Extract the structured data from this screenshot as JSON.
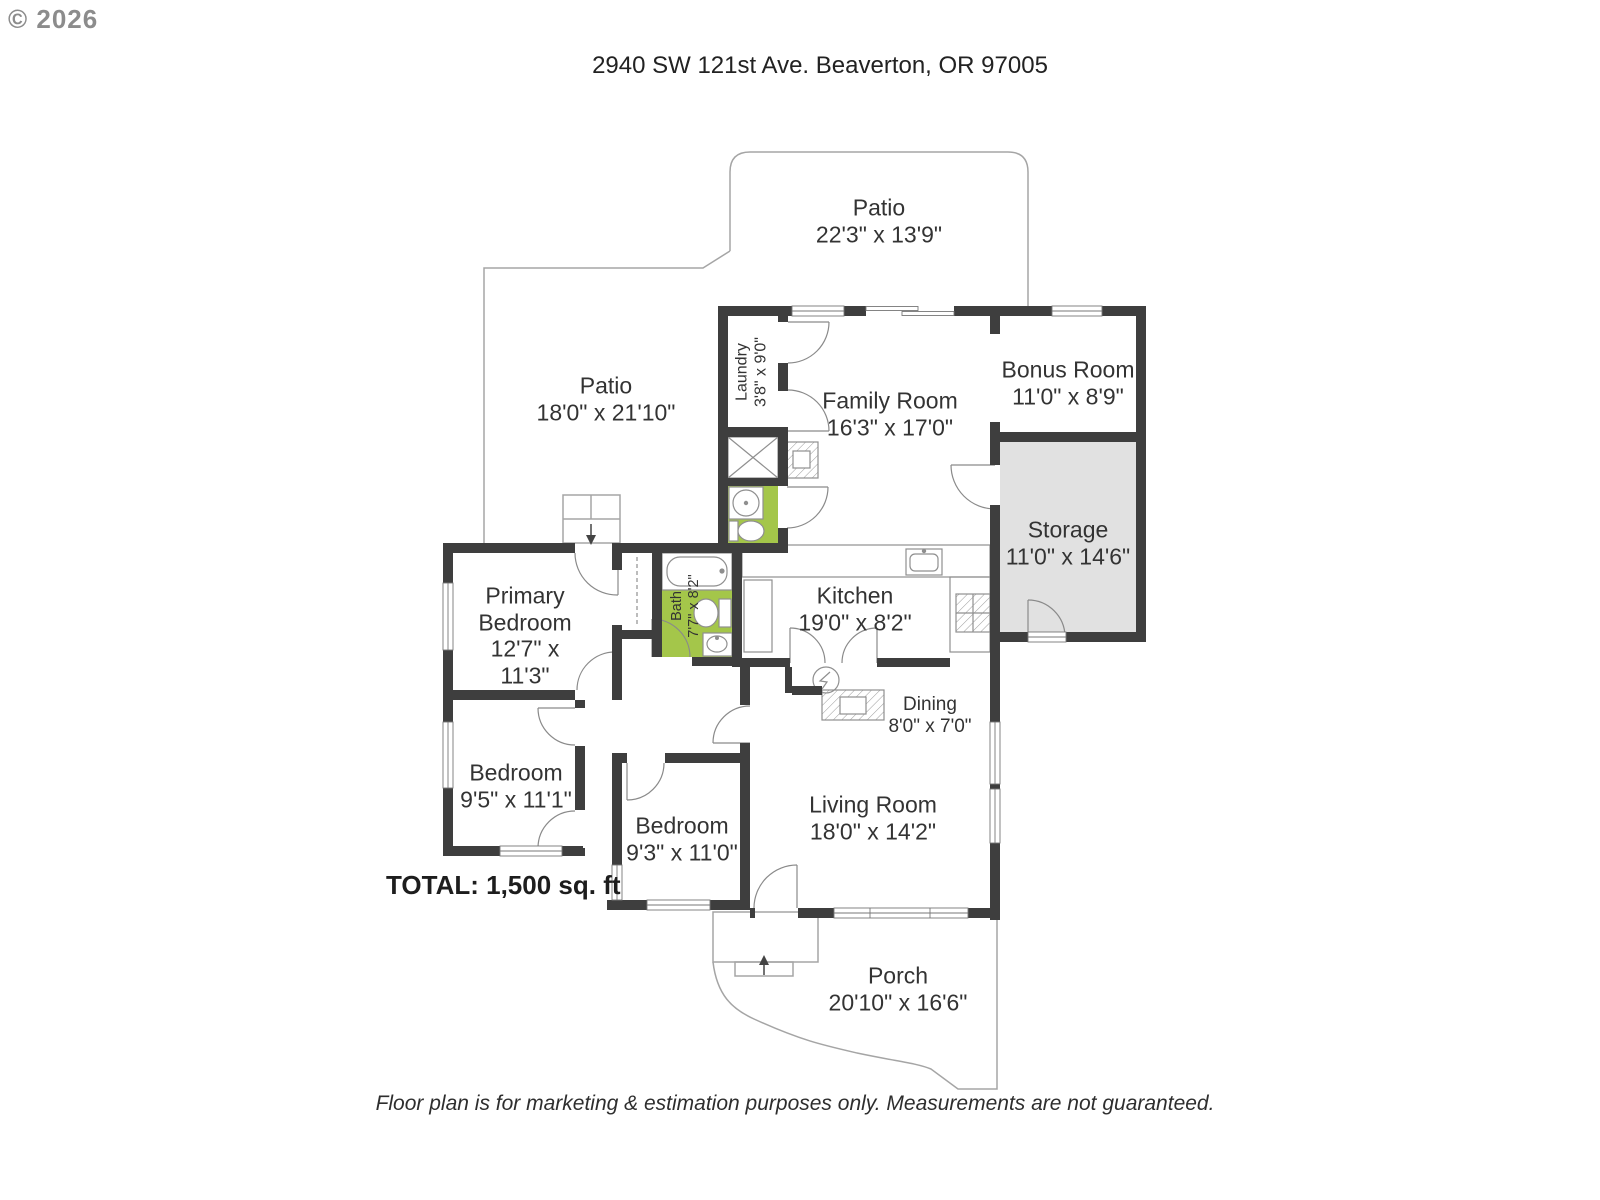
{
  "watermark": "© 2026",
  "title": "2940 SW 121st Ave. Beaverton, OR 97005",
  "total": "TOTAL: 1,500 sq. ft",
  "disclaimer": "Floor plan is for marketing & estimation purposes only. Measurements are not guaranteed.",
  "colors": {
    "wall": "#3e3e3e",
    "green": "#a4c64a",
    "storage": "#e1e1e1",
    "line": "#8f8f8f",
    "outline": "#a5a5a5",
    "text": "#333333",
    "watermark": "#8c8c8c"
  },
  "rooms": {
    "patio_top": {
      "name": "Patio",
      "dims": "22'3\" x 13'9\""
    },
    "patio_left": {
      "name": "Patio",
      "dims": "18'0\" x 21'10\""
    },
    "laundry": {
      "name": "Laundry",
      "dims": "3'8\" x 9'0\""
    },
    "family": {
      "name": "Family Room",
      "dims": "16'3\" x 17'0\""
    },
    "bonus": {
      "name": "Bonus Room",
      "dims": "11'0\" x 8'9\""
    },
    "storage": {
      "name": "Storage",
      "dims": "11'0\" x 14'6\""
    },
    "primary": {
      "name": "Primary Bedroom",
      "dims": "12'7\" x 11'3\""
    },
    "bath": {
      "name": "Bath",
      "dims": "7'7\" x 8'2\""
    },
    "kitchen": {
      "name": "Kitchen",
      "dims": "19'0\" x 8'2\""
    },
    "dining": {
      "name": "Dining",
      "dims": "8'0\" x 7'0\""
    },
    "bedroom1": {
      "name": "Bedroom",
      "dims": "9'5\" x 11'1\""
    },
    "bedroom2": {
      "name": "Bedroom",
      "dims": "9'3\" x 11'0\""
    },
    "living": {
      "name": "Living Room",
      "dims": "18'0\" x 14'2\""
    },
    "porch": {
      "name": "Porch",
      "dims": "20'10\" x 16'6\""
    }
  }
}
